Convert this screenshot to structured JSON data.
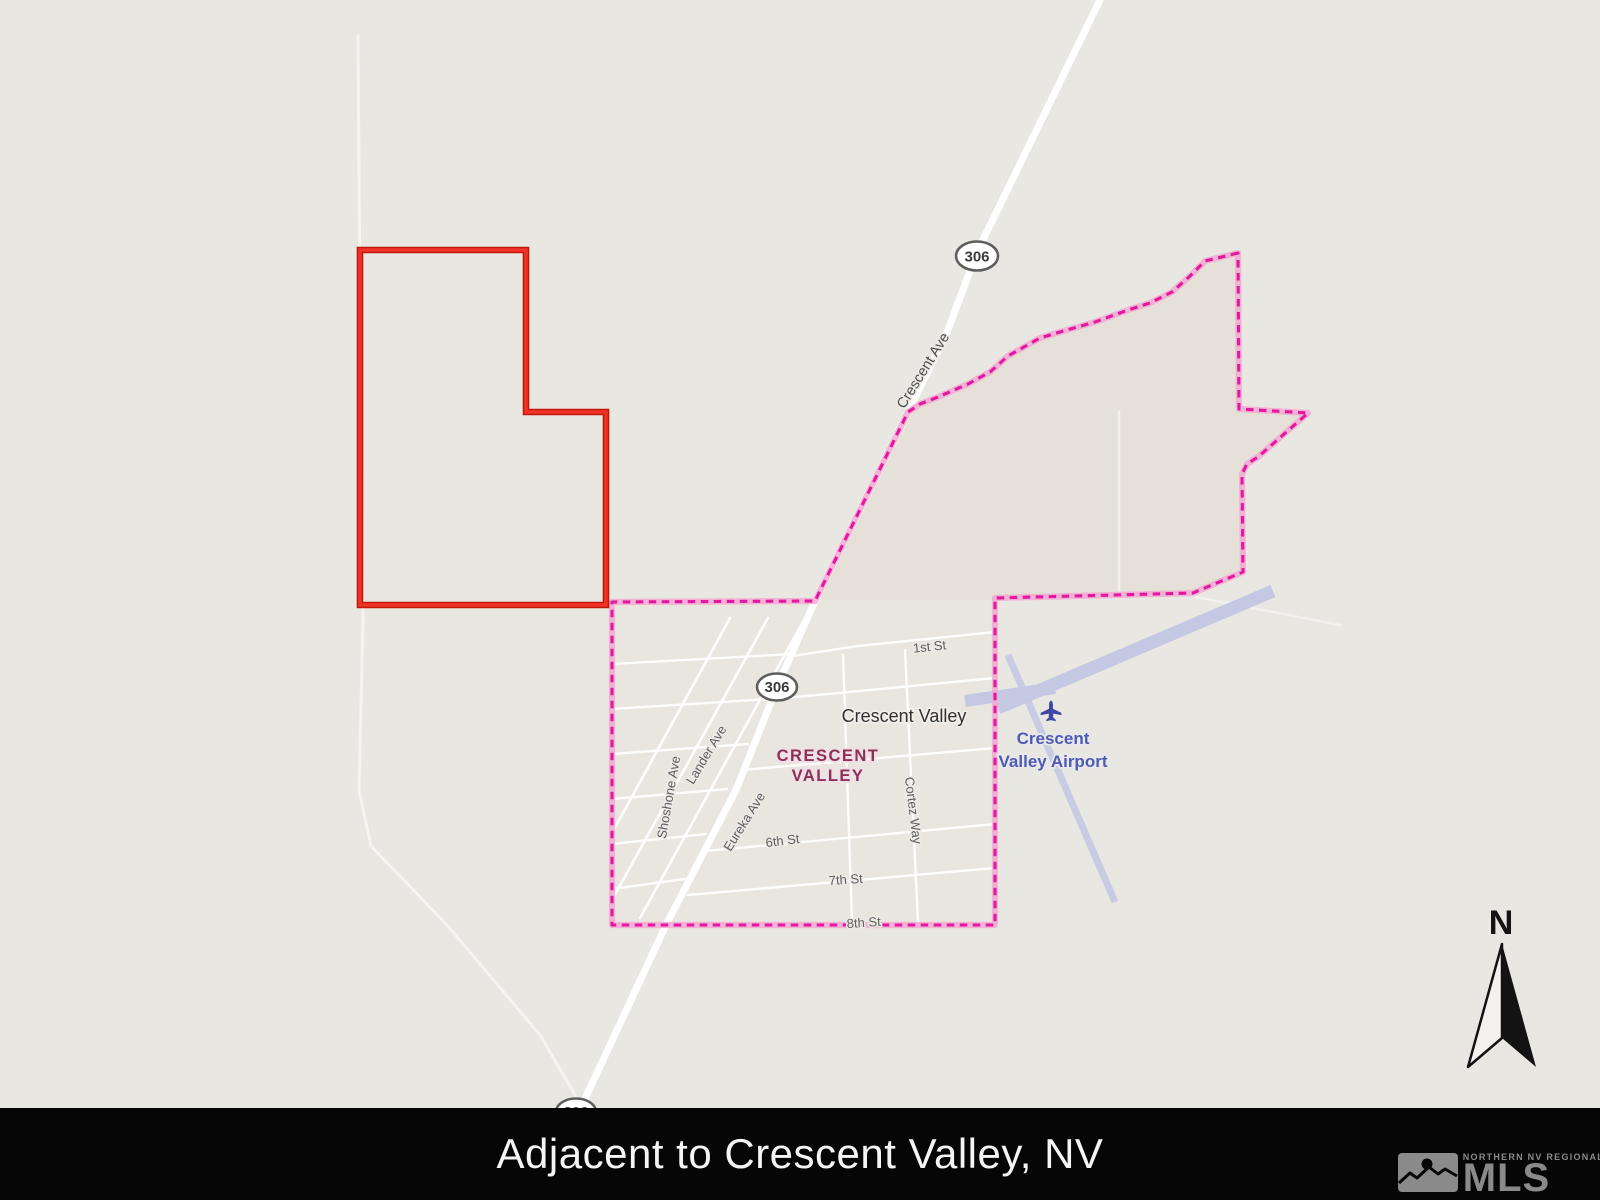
{
  "map": {
    "compass": {
      "label": "N"
    },
    "route_shields": [
      {
        "label": "306"
      },
      {
        "label": "306"
      },
      {
        "label": "306"
      }
    ],
    "road_labels": {
      "crescent_ave": "Crescent Ave"
    },
    "town": {
      "name": "Crescent Valley"
    },
    "locality_label": {
      "line1": "CRESCENT",
      "line2": "VALLEY"
    },
    "airport": {
      "line1": "Crescent",
      "line2": "Valley Airport"
    },
    "streets": {
      "first_st": "1st St",
      "sixth_st": "6th St",
      "seventh_st": "7th St",
      "eighth_st": "8th St",
      "shoshone_ave": "Shoshone Ave",
      "lander_ave": "Lander Ave",
      "eureka_ave": "Eureka Ave",
      "cortez_way": "Cortez Way"
    },
    "colors": {
      "map_background": "#e9e7e2",
      "parcel_outline_red": "#e0251b",
      "boundary_pink": "#e2189e",
      "boundary_halo": "#f3a8d3",
      "road_white": "#ffffff",
      "runway_lavender": "#c4c8e2",
      "airport_text": "#4f5ab3",
      "locality_text": "#8d3057",
      "street_text": "#5f5f5f"
    }
  },
  "footer": {
    "title": "Adjacent to Crescent Valley, NV",
    "background": "#060606",
    "mls_logo": {
      "tagline": "NORTHERN NV REGIONAL",
      "name": "MLS"
    }
  }
}
